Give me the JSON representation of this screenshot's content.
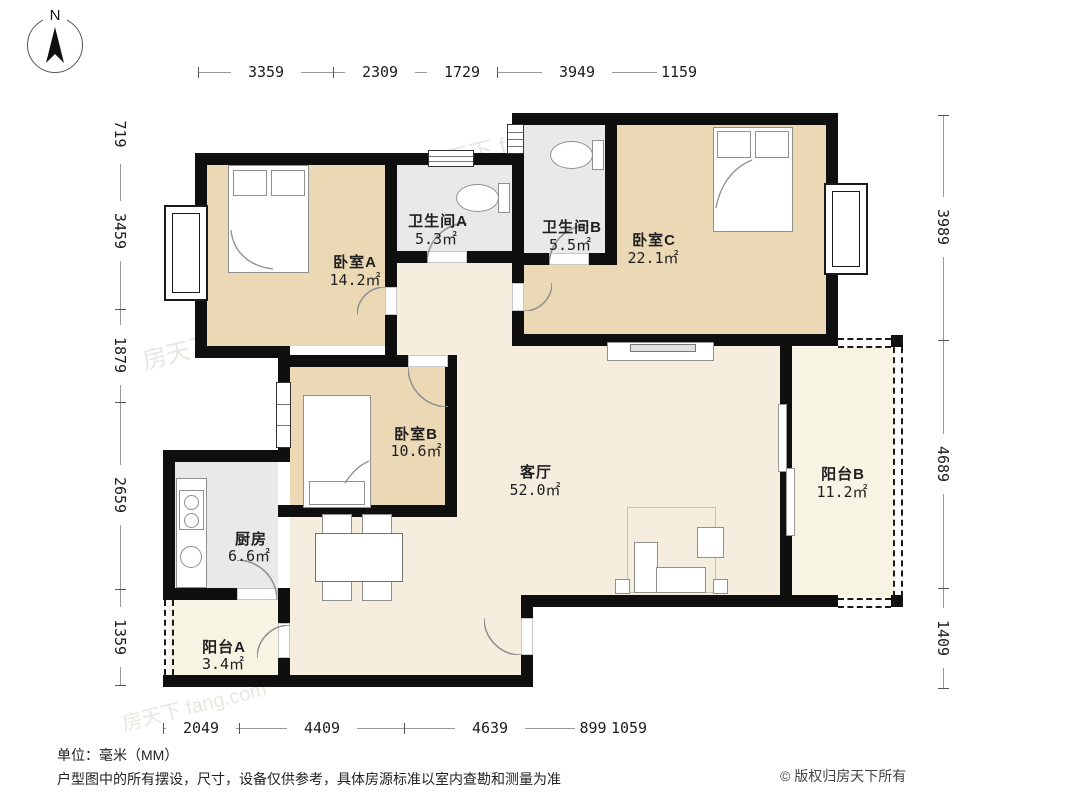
{
  "compass": {
    "north_label": "N"
  },
  "dimensions": {
    "top": [
      "3359",
      "2309",
      "1729",
      "3949",
      "1159"
    ],
    "bottom": [
      "2049",
      "4409",
      "4639",
      "899",
      "1059"
    ],
    "left": [
      "719",
      "3459",
      "1879",
      "2659",
      "1359"
    ],
    "right": [
      "3989",
      "4689",
      "1409"
    ]
  },
  "rooms": {
    "bedroom_a": {
      "name": "卧室A",
      "area": "14.2㎡"
    },
    "bedroom_b": {
      "name": "卧室B",
      "area": "10.6㎡"
    },
    "bedroom_c": {
      "name": "卧室C",
      "area": "22.1㎡"
    },
    "bathroom_a": {
      "name": "卫生间A",
      "area": "5.3㎡"
    },
    "bathroom_b": {
      "name": "卫生间B",
      "area": "5.5㎡"
    },
    "living_room": {
      "name": "客厅",
      "area": "52.0㎡"
    },
    "kitchen": {
      "name": "厨房",
      "area": "6.6㎡"
    },
    "balcony_a": {
      "name": "阳台A",
      "area": "3.4㎡"
    },
    "balcony_b": {
      "name": "阳台B",
      "area": "11.2㎡"
    }
  },
  "footer": {
    "unit_note": "单位：毫米（MM）",
    "disclaimer": "户型图中的所有摆设，尺寸，设备仅供参考，具体房源标准以室内查勘和测量为准",
    "copyright": "© 版权归房天下所有"
  },
  "watermark": {
    "text": "房天下 fang.com"
  },
  "colors": {
    "bedroom_fill": "#ebd9b5",
    "living_fill": "#f5edde",
    "wet_fill": "#e9e9e9",
    "balcony_fill": "#f8f4e3",
    "wall": "#0f0f0f"
  }
}
